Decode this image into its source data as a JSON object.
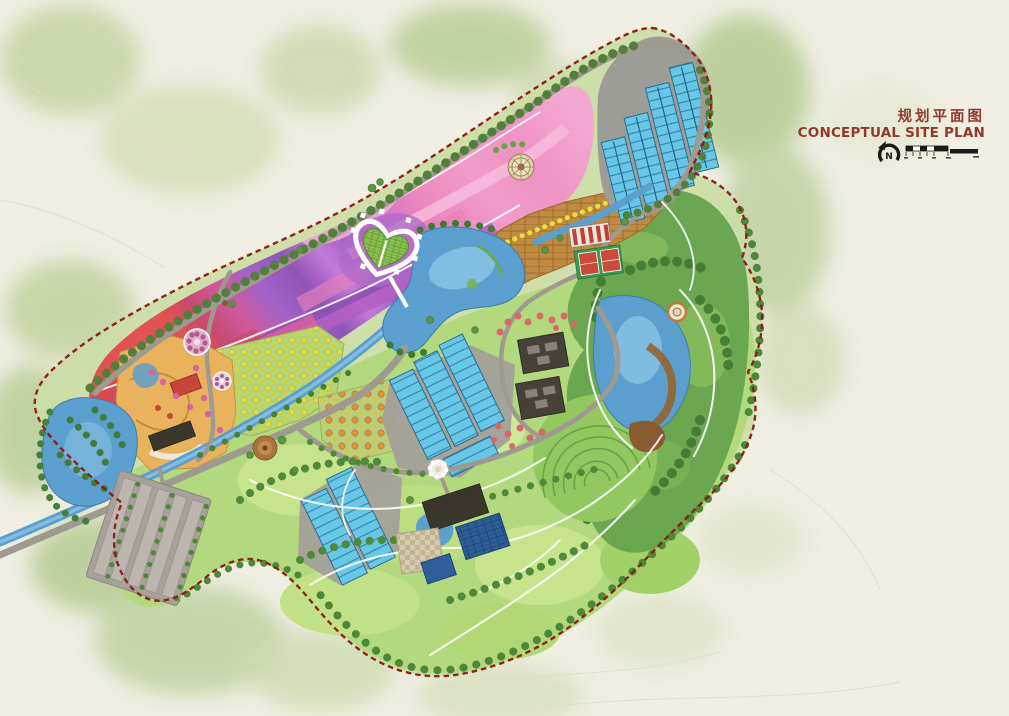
{
  "page": {
    "background": "#f0efe2"
  },
  "header": {
    "title_zh": "规划平面图",
    "title_en": "CONCEPTUAL SITE PLAN",
    "north_label": "N"
  },
  "icons": {
    "north_arrow": "north-arrow-icon",
    "scale_bar": "scale-bar"
  },
  "colors": {
    "background": "#f0efe2",
    "canvas_wash": "#bccf9b",
    "boundary": "#8c190f",
    "road": "#9e9a90",
    "path_white": "#ffffff",
    "lake": "#5b9fce",
    "lake_light": "#8ec4e4",
    "greenhouse": "#68c6e6",
    "greenhouse_pad": "#9d9d97",
    "flower_red": "#e15252",
    "flower_magenta": "#cf5a9b",
    "flower_purple": "#8f55b6",
    "flower_violet": "#c47ad8",
    "flower_pink": "#f09cc8",
    "orchard_yellow": "#dede44",
    "orchard_orange": "#e0913c",
    "terrace_brown": "#c08a42",
    "hill_green": "#b3d97e",
    "forest_green": "#66a44e",
    "tree_dark": "#4d8838",
    "building_dark": "#46423a",
    "building_navy": "#2f5f98",
    "court_red": "#cb4a3a",
    "court_green": "#3d9a52",
    "title": "#8e3a2c",
    "ink": "#1d1a17"
  },
  "map": {
    "features": [
      "flower-terrace-fields",
      "heart-shaped-garden",
      "observation-tower-plaza",
      "north-greenhouse-complex",
      "central-greenhouse-complex",
      "south-greenhouse-complex",
      "central-lake",
      "east-lake",
      "west-wetland-lake",
      "stream-corridor",
      "orchard-areas",
      "terraced-farm-plots",
      "entrance-courtyard",
      "sports-courts",
      "courtyard-buildings",
      "tea-terrace-contours",
      "hillside-meadows",
      "forest-area",
      "parking-lot",
      "farmstead-buildings",
      "flower-roundabout",
      "site-boundary",
      "perimeter-road"
    ]
  }
}
